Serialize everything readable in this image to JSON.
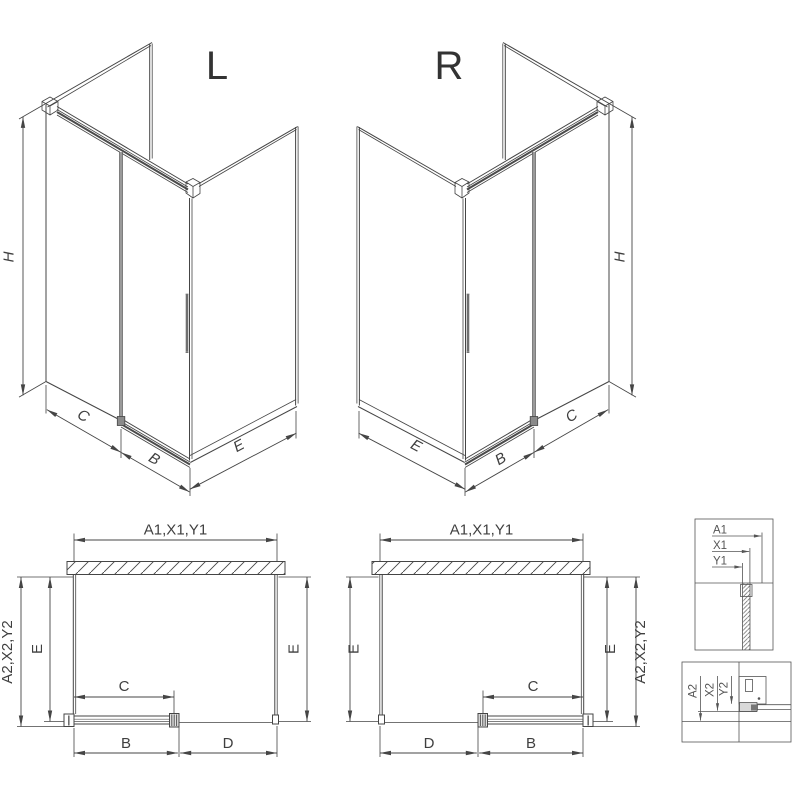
{
  "iso_left": {
    "title": "L",
    "dims": {
      "h": "H",
      "c": "C",
      "b": "B",
      "e": "E"
    }
  },
  "iso_right": {
    "title": "R",
    "dims": {
      "h": "H",
      "c": "C",
      "b": "B",
      "e": "E"
    }
  },
  "plan_left": {
    "width_top": "A1,X1,Y1",
    "depth_outer": "A2,X2,Y2",
    "depth_left": "E",
    "depth_right": "E",
    "door_glass": "C",
    "door_width": "B",
    "opening": "D"
  },
  "plan_right": {
    "width_top": "A1,X1,Y1",
    "depth_outer": "A2,X2,Y2",
    "depth_left": "E",
    "depth_right": "E",
    "door_glass": "C",
    "door_width": "B",
    "opening": "D"
  },
  "detail_top": {
    "a1": "A1",
    "x1": "X1",
    "y1": "Y1"
  },
  "detail_bottom": {
    "a2": "A2",
    "x2": "X2",
    "y2": "Y2"
  },
  "colors": {
    "line": "#454545",
    "profile_gray": "#9a9a9a",
    "label": "#3f3f3f",
    "detail_label": "#555555",
    "background": "#ffffff"
  }
}
